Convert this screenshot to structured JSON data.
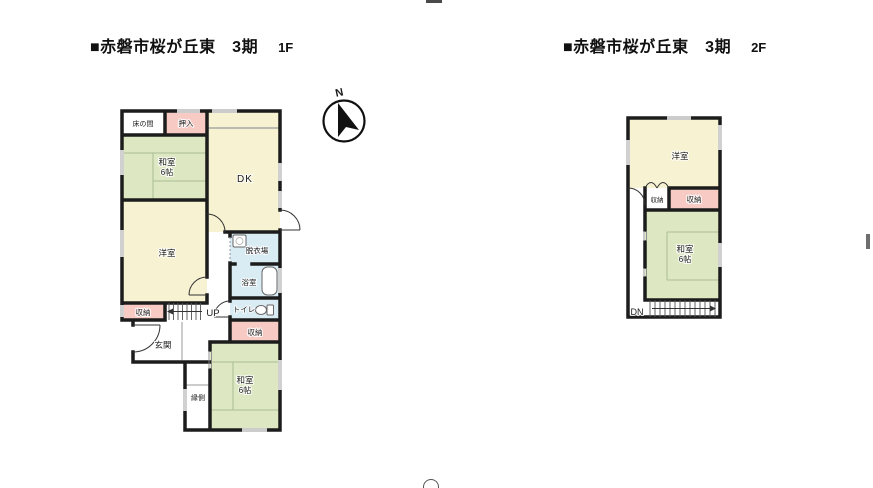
{
  "header": {
    "floor1_title": "■赤磐市桜が丘東　3期",
    "floor1_floor": "1F",
    "floor2_title": "■赤磐市桜が丘東　3期",
    "floor2_floor": "2F"
  },
  "compass": {
    "north_label": "N"
  },
  "colors": {
    "wall": "#1c1c1c",
    "room_yellow": "#f6f2d2",
    "room_green": "#dde8c3",
    "room_pink": "#f7cac4",
    "room_blue": "#d9ebf3",
    "tatami_line": "#a9bd90",
    "window_line": "#999999"
  },
  "floor1": {
    "tokonoma": "床の間",
    "oshiire": "押入",
    "washitsu_upper": "和室",
    "washitsu_upper_size": "6帖",
    "dk": "DK",
    "youshitsu": "洋室",
    "datsuijo": "脱衣場",
    "yokushitsu": "浴室",
    "toire": "トイレ",
    "shuno_left": "収納",
    "up": "UP",
    "genkan": "玄関",
    "shuno_right": "収納",
    "washitsu_lower": "和室",
    "washitsu_lower_size": "6帖",
    "engawa": "縁側"
  },
  "floor2": {
    "youshitsu": "洋室",
    "shuno_left": "収納",
    "shuno_right": "収納",
    "washitsu": "和室",
    "washitsu_size": "6帖",
    "dn": "DN"
  }
}
